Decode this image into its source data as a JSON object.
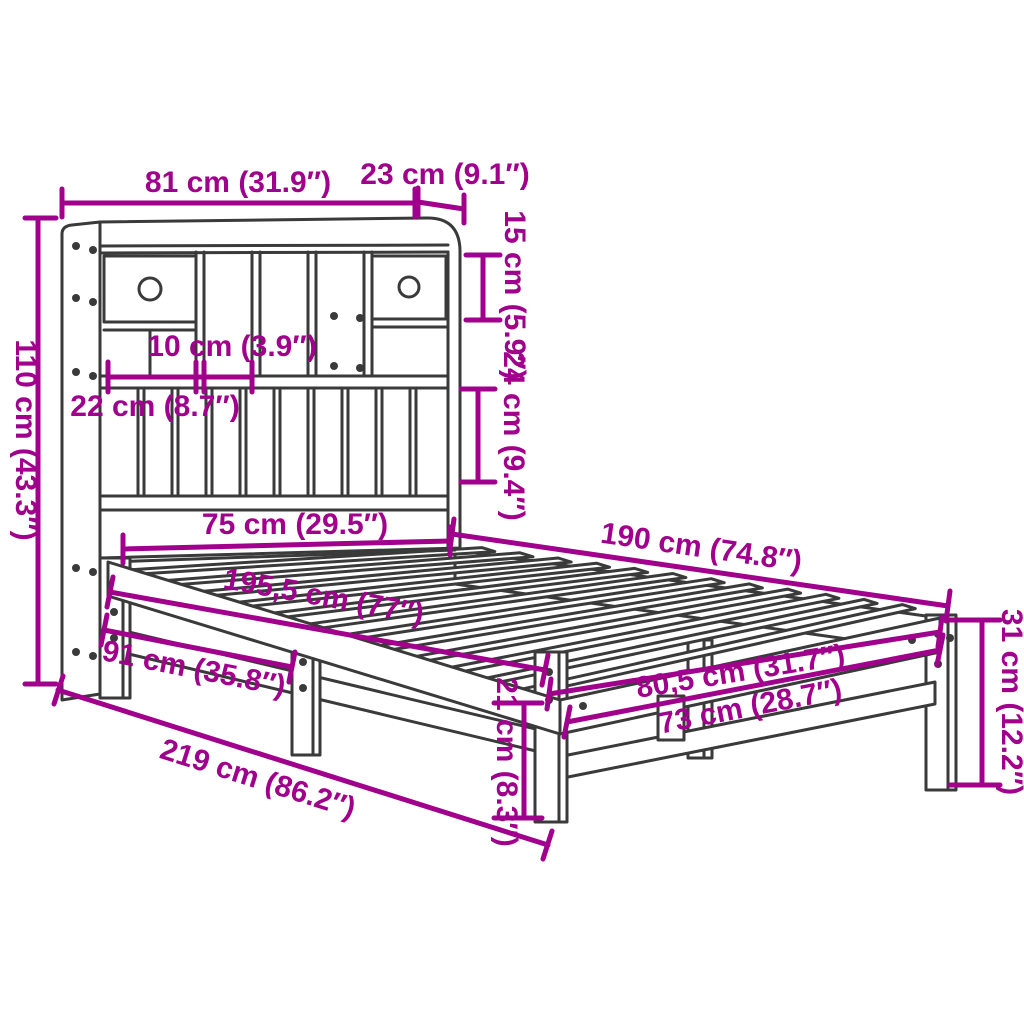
{
  "diagram": {
    "type": "furniture-dimension-diagram",
    "subject": "bookcase bed with shelf headboard",
    "accent_color": "#A1008C",
    "line_color": "#3A3A3A",
    "background": "#FFFFFF",
    "dimensions": {
      "headboard_width": "81 cm (31.9″)",
      "headboard_top_depth": "23 cm (9.1″)",
      "top_compartment_height": "15 cm (5.9″)",
      "headboard_height": "110 cm (43.3″)",
      "small_compartment_width": "10 cm (3.9″)",
      "wide_compartment_width": "22 cm (8.7″)",
      "lower_compartment_height": "24 cm (9.4″)",
      "bed_width_head": "75 cm (29.5″)",
      "bed_length": "190 cm (74.8″)",
      "total_length": "195,5 cm (77″)",
      "headboard_to_center_leg": "91 cm (35.8″)",
      "overall_length": "219 cm (86.2″)",
      "underbed_clearance": "21 cm (8.3″)",
      "foot_inner_width": "73 cm (28.7″)",
      "foot_outer_width": "80,5 cm (31.7″)",
      "frame_height": "31 cm (12.2″)"
    }
  }
}
